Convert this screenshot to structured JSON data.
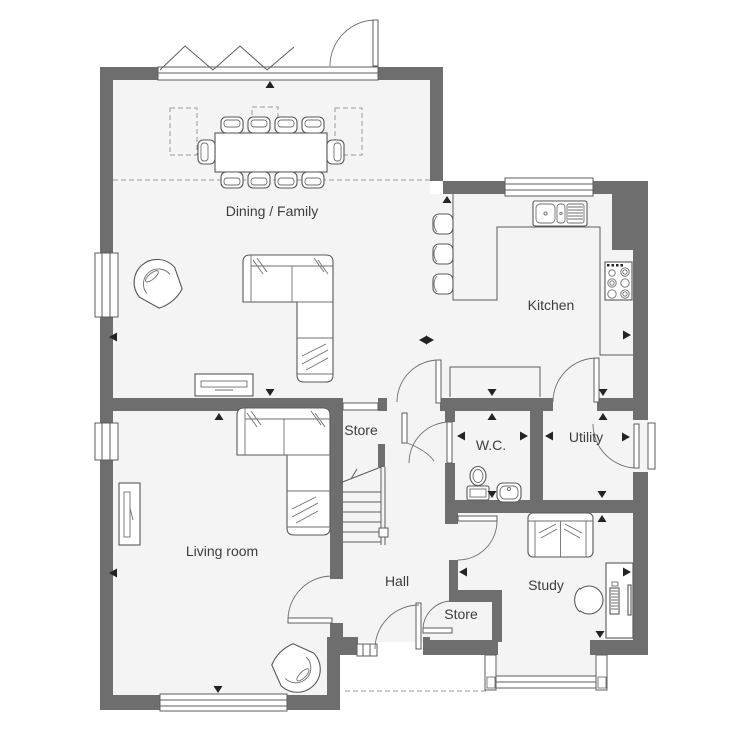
{
  "floorplan": {
    "rooms": [
      {
        "id": "dining-family",
        "label": "Dining / Family"
      },
      {
        "id": "kitchen",
        "label": "Kitchen"
      },
      {
        "id": "living-room",
        "label": "Living room"
      },
      {
        "id": "hall",
        "label": "Hall"
      },
      {
        "id": "store-upper",
        "label": "Store"
      },
      {
        "id": "wc",
        "label": "W.C."
      },
      {
        "id": "utility",
        "label": "Utility"
      },
      {
        "id": "study",
        "label": "Study"
      },
      {
        "id": "store-lower",
        "label": "Store"
      }
    ],
    "symbols": [
      "bifold-doors",
      "garden-door",
      "roof-lights",
      "dining-table",
      "dining-chairs",
      "tub-armchair",
      "corner-sofa",
      "tv-unit",
      "breakfast-bar",
      "bar-stools",
      "kitchen-sink",
      "hob",
      "worktop",
      "cupboard",
      "toilet",
      "hand-basin",
      "staircase",
      "front-door",
      "side-light",
      "bay-window",
      "two-seat-sofa",
      "desk",
      "desk-chair",
      "computer-tower",
      "monitor",
      "porch-canopy-dashed",
      "dimension-markers"
    ],
    "colors": {
      "wall": "#6e6e6e",
      "floor": "#f4f4f5",
      "outline": "#5c5c5c",
      "dashed": "#9a9a9a",
      "marker": "#232323",
      "label": "#3d3d3d",
      "background": "#ffffff"
    }
  }
}
